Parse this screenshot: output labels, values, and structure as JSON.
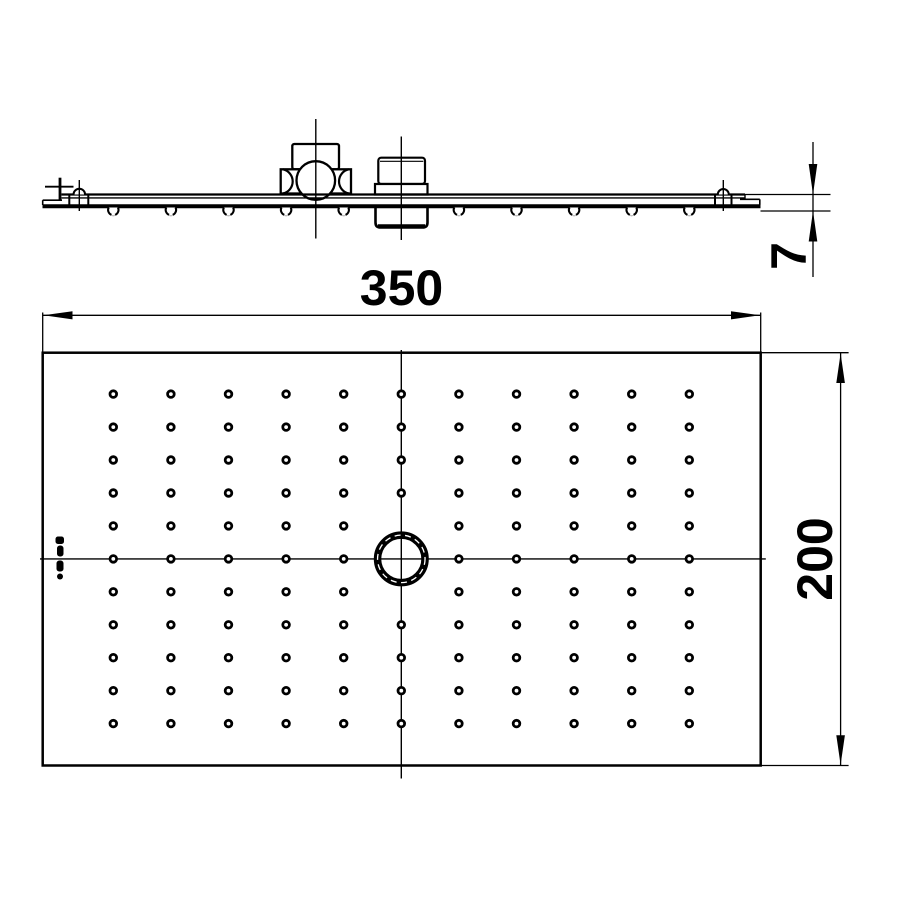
{
  "dimension_labels": {
    "width": "350",
    "height": "200",
    "thickness": "7"
  },
  "plan_view": {
    "grid": {
      "cols": 11,
      "rows": 11,
      "origin_x": 113.3,
      "origin_y": 394.1,
      "col_spacing": 57.6,
      "row_spacing": 32.95,
      "dot_radius": 3.3,
      "missing_cells": [
        [
          5,
          4
        ],
        [
          5,
          5
        ],
        [
          5,
          6
        ]
      ]
    },
    "center_circle": {
      "cx": 401.3,
      "cy": 558.9,
      "r": 23.75,
      "ring_width": 7.5
    }
  },
  "side_view": {
    "nozzle_columns": [
      113.3,
      170.9,
      228.5,
      286.1,
      343.7,
      458.9,
      516.5,
      574.1,
      631.7,
      689.3
    ]
  },
  "colors": {
    "ink": "#000000",
    "paper": "#ffffff"
  }
}
